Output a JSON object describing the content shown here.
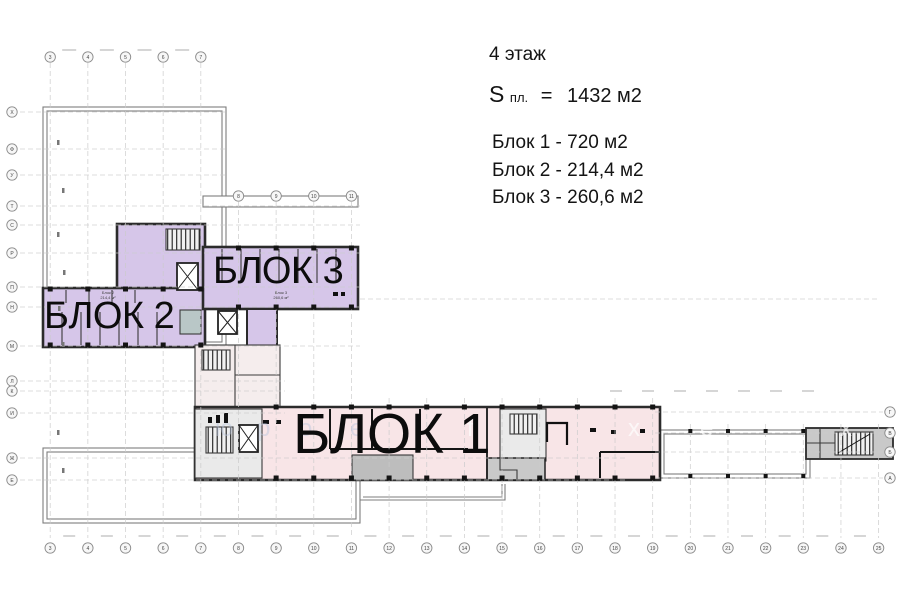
{
  "info": {
    "floor": "4 этаж",
    "s": "S",
    "s_sub": "пл.",
    "eq": "=",
    "total": "1432 м2",
    "block_lines": [
      "Блок 1 - 720 м2",
      "Блок 2 - 214,4 м2",
      "Блок 3 - 260,6 м2"
    ]
  },
  "plan": {
    "block1": "БЛОК 1",
    "block2": "БЛОК 2",
    "block3": "БЛОК 3"
  },
  "annotations": [
    {
      "line1": "Блок 2",
      "line2": "214,4 м²"
    },
    {
      "line1": "Блок 3",
      "line2": "260,6 м²"
    }
  ],
  "axis": {
    "top_numbers": [
      "3",
      "4",
      "5",
      "6",
      "7"
    ],
    "mid_numbers": [
      "8",
      "9",
      "10",
      "11"
    ],
    "bottom_numbers": [
      "3",
      "4",
      "5",
      "6",
      "7",
      "8",
      "9",
      "10",
      "11",
      "12",
      "13",
      "14",
      "15",
      "16",
      "17",
      "18",
      "19",
      "20",
      "21",
      "22",
      "23",
      "24",
      "25"
    ],
    "left_letters": [
      "Х",
      "Ф",
      "У",
      "Т",
      "С",
      "Р",
      "П",
      "Н",
      "М",
      "Л",
      "К",
      "И",
      "Ж",
      "Е"
    ],
    "right_letters": [
      "Г",
      "В",
      "Б",
      "А"
    ]
  },
  "watermark_letters": [
    "ю",
    "р",
    "о",
    "е",
    "f",
    "х",
    "е",
    "х"
  ],
  "colors": {
    "purple": "#d6c6e9",
    "pink": "#f8e5e7",
    "core_gray": "#eaeaea",
    "mid_gray": "#bdbdbd",
    "teal": "#b9c7c7",
    "wall_dark": "#2b2b2b",
    "outline_gray": "#7d7d7d",
    "grid": "#cbcbcb"
  }
}
